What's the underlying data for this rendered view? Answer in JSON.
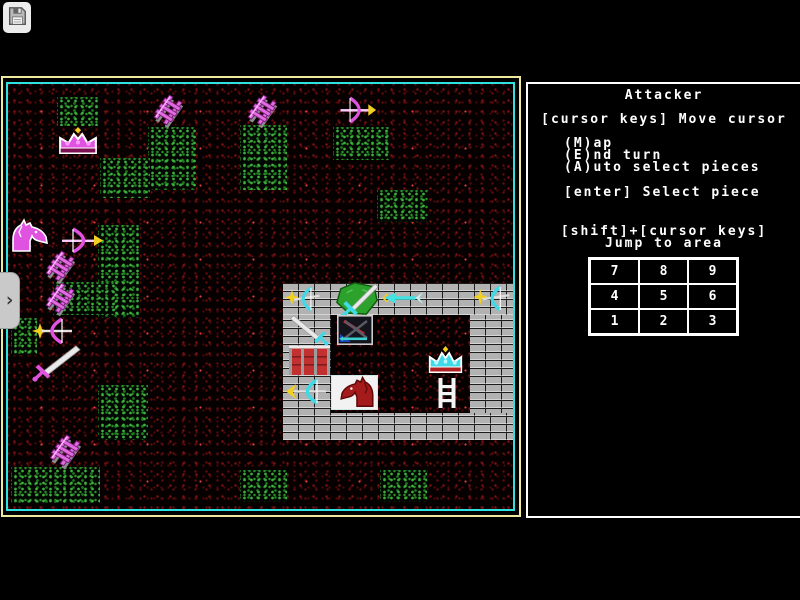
{
  "toolbar": {
    "save_icon": "floppy-disk"
  },
  "side_tab": {
    "chevron": "›"
  },
  "panel": {
    "title": "Attacker",
    "line_move_cursor": "[cursor keys] Move cursor",
    "cmd_map": "(M)ap",
    "cmd_end_turn": "(E)nd turn",
    "cmd_auto_select": "(A)uto select pieces",
    "cmd_select_piece": "[enter] Select piece",
    "jump_keys": "[shift]+[cursor keys]",
    "jump_label": "Jump to area",
    "jump_grid": [
      [
        "7",
        "8",
        "9"
      ],
      [
        "4",
        "5",
        "6"
      ],
      [
        "1",
        "2",
        "3"
      ]
    ]
  },
  "board": {
    "colors": {
      "frame_outer": "#efe9a0",
      "frame_inner": "#2ee2e2",
      "attacker": "#e052e0",
      "defender": "#3fd9e8",
      "spark": "#f2d01f",
      "forest": "#2a8f2a",
      "ground_speckle": "#7a1212",
      "wall": "#b2b2b2",
      "barricade": "#c23030"
    },
    "terrain_patches": [
      {
        "x": 57,
        "y": 97,
        "w": 43,
        "h": 29
      },
      {
        "x": 148,
        "y": 127,
        "w": 48,
        "h": 63
      },
      {
        "x": 100,
        "y": 158,
        "w": 50,
        "h": 40
      },
      {
        "x": 240,
        "y": 125,
        "w": 47,
        "h": 65
      },
      {
        "x": 333,
        "y": 127,
        "w": 57,
        "h": 33
      },
      {
        "x": 377,
        "y": 190,
        "w": 51,
        "h": 32
      },
      {
        "x": 98,
        "y": 225,
        "w": 42,
        "h": 93
      },
      {
        "x": 53,
        "y": 282,
        "w": 62,
        "h": 33
      },
      {
        "x": 11,
        "y": 318,
        "w": 26,
        "h": 37
      },
      {
        "x": 98,
        "y": 385,
        "w": 50,
        "h": 55
      },
      {
        "x": 11,
        "y": 467,
        "w": 89,
        "h": 36
      },
      {
        "x": 240,
        "y": 470,
        "w": 47,
        "h": 32
      },
      {
        "x": 380,
        "y": 470,
        "w": 47,
        "h": 32
      }
    ],
    "castle_walls": [
      {
        "x": 283,
        "y": 283,
        "w": 230,
        "h": 32
      },
      {
        "x": 283,
        "y": 315,
        "w": 48,
        "h": 125
      },
      {
        "x": 470,
        "y": 315,
        "w": 43,
        "h": 125
      },
      {
        "x": 283,
        "y": 413,
        "w": 230,
        "h": 27
      }
    ],
    "pieces": [
      {
        "name": "piece-crown-attacker",
        "type": "crown-magenta",
        "x": 57,
        "y": 127,
        "w": 42,
        "h": 31
      },
      {
        "name": "piece-ladder",
        "type": "ladder-magenta",
        "x": 152,
        "y": 96,
        "w": 32,
        "h": 30
      },
      {
        "name": "piece-ladder",
        "type": "ladder-magenta",
        "x": 246,
        "y": 96,
        "w": 32,
        "h": 30
      },
      {
        "name": "piece-bow-attacker",
        "type": "bow-right-magenta",
        "x": 337,
        "y": 96,
        "w": 40,
        "h": 28
      },
      {
        "name": "piece-knight-attacker",
        "type": "knight-magenta",
        "x": 9,
        "y": 219,
        "w": 42,
        "h": 33
      },
      {
        "name": "piece-bow-attacker",
        "type": "bow-right-magenta",
        "x": 58,
        "y": 227,
        "w": 46,
        "h": 27
      },
      {
        "name": "piece-ladder",
        "type": "ladder-magenta",
        "x": 44,
        "y": 252,
        "w": 32,
        "h": 30
      },
      {
        "name": "piece-ladder",
        "type": "ladder-magenta",
        "x": 44,
        "y": 284,
        "w": 32,
        "h": 30
      },
      {
        "name": "piece-bow-attacker",
        "type": "bow-left-spark-magenta",
        "x": 30,
        "y": 316,
        "w": 46,
        "h": 30
      },
      {
        "name": "piece-sword-attacker",
        "type": "sword-magenta",
        "x": 28,
        "y": 344,
        "w": 52,
        "h": 38
      },
      {
        "name": "piece-ladder",
        "type": "ladder-magenta",
        "x": 48,
        "y": 436,
        "w": 34,
        "h": 31
      },
      {
        "name": "piece-bow-defender",
        "type": "bow-spark-cyan",
        "x": 285,
        "y": 284,
        "w": 38,
        "h": 30
      },
      {
        "name": "piece-shield-defender",
        "type": "shield-sword",
        "x": 333,
        "y": 281,
        "w": 47,
        "h": 37
      },
      {
        "name": "piece-arrow-defender",
        "type": "arrow-left-cyan",
        "x": 382,
        "y": 289,
        "w": 42,
        "h": 18
      },
      {
        "name": "piece-bow-defender",
        "type": "bow-spark-cyan",
        "x": 473,
        "y": 283,
        "w": 40,
        "h": 31
      },
      {
        "name": "piece-sword-defender",
        "type": "sword-cyan",
        "x": 290,
        "y": 314,
        "w": 42,
        "h": 32
      },
      {
        "name": "piece-barricade",
        "type": "barricade-red",
        "x": 288,
        "y": 344,
        "w": 43,
        "h": 32
      },
      {
        "name": "piece-bow-defender",
        "type": "bow-flame-cyan",
        "x": 284,
        "y": 376,
        "w": 46,
        "h": 31
      },
      {
        "name": "piece-battle-tile",
        "type": "battle-tile",
        "x": 337,
        "y": 315,
        "w": 36,
        "h": 30
      },
      {
        "name": "piece-crown-defender",
        "type": "crown-cyan",
        "x": 427,
        "y": 346,
        "w": 37,
        "h": 31
      },
      {
        "name": "piece-ladder-white",
        "type": "ladder-white",
        "x": 436,
        "y": 377,
        "w": 22,
        "h": 32
      },
      {
        "name": "piece-knight-defender",
        "type": "knight-tile-red",
        "x": 331,
        "y": 375,
        "w": 47,
        "h": 35
      }
    ]
  }
}
